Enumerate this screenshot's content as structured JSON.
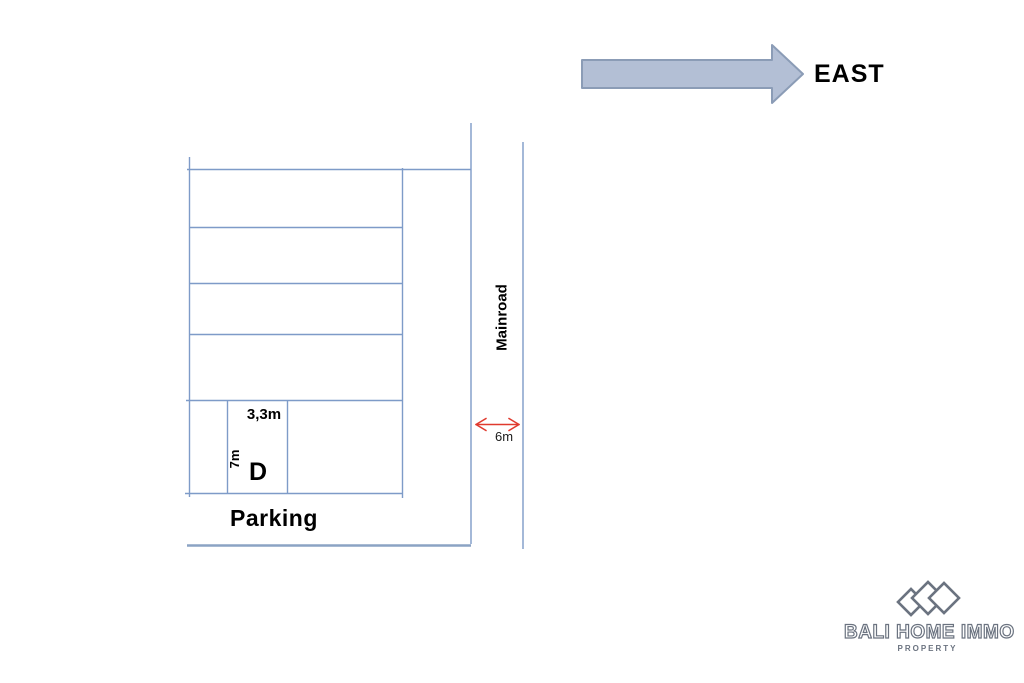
{
  "colors": {
    "line": "#7e9bc8",
    "boundary": "#8ba3c4",
    "arrow-fill": "#b3bfd5",
    "arrow-stroke": "#8b9cb6",
    "dim-arrow": "#e03a2e",
    "logo": "#6b7380",
    "text": "#000000"
  },
  "compass": {
    "label": "EAST"
  },
  "plan": {
    "road_label": "Mainroad",
    "road_width_label": "6m",
    "plot_width_label": "3,3m",
    "plot_depth_label": "7m",
    "plot_letter": "D",
    "parking_label": "Parking"
  },
  "logo": {
    "title": "BALI HOME IMMO",
    "subtitle": "PROPERTY"
  }
}
